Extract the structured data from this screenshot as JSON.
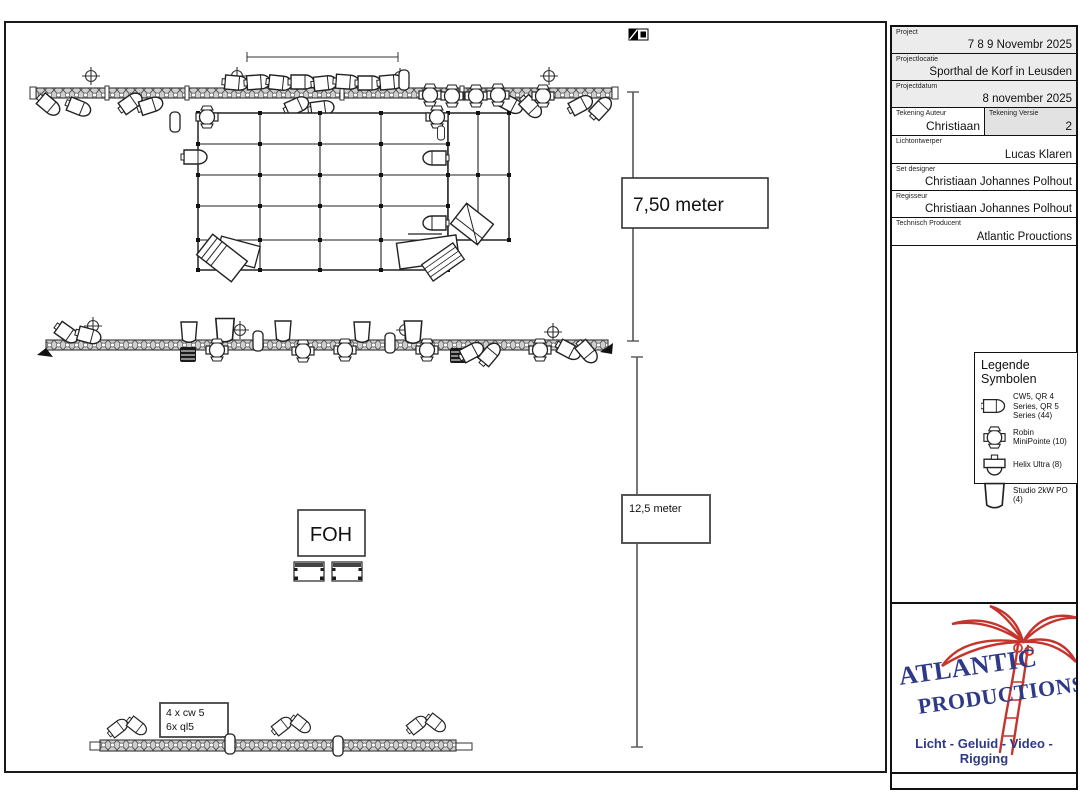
{
  "drawing": {
    "dim_width_label": "7,50 meter",
    "dim_depth_label": "12,5 meter",
    "foh_label": "FOH",
    "truss_note_line1": "4 x cw 5",
    "truss_note_line2": "6x ql5"
  },
  "title_block": {
    "rows": [
      {
        "label": "Project",
        "value": "7 8 9 Novembr 2025"
      },
      {
        "label": "Projectlocatie",
        "value": "Sporthal de Korf in Leusden"
      },
      {
        "label": "Projectdatum",
        "value": "8 november 2025"
      }
    ],
    "author_label": "Tekening Auteur",
    "author_value": "Christiaan",
    "version_label": "Tekening Versie",
    "version_value": "2",
    "rows2": [
      {
        "label": "Lichtontwerper",
        "value": "Lucas Klaren"
      },
      {
        "label": "Set designer",
        "value": "Christiaan Johannes Polhout"
      },
      {
        "label": "Regisseur",
        "value": "Christiaan Johannes Polhout"
      },
      {
        "label": "Technisch Producent",
        "value": "Atlantic Prouctions"
      }
    ]
  },
  "legend": {
    "title": "Legende Symbolen",
    "items": [
      {
        "icon": "wash-fixture-icon",
        "label": "CW5, QR 4 Series, QR 5 Series (44)"
      },
      {
        "icon": "moving-head-icon",
        "label": "Robin MiniPointe (10)"
      },
      {
        "icon": "helix-ultra-icon",
        "label": "Helix Ultra (8)"
      },
      {
        "icon": "par-can-icon",
        "label": "Studio 2kW PO (4)"
      }
    ]
  },
  "logo": {
    "line1": "ATLANTIC",
    "line2": "PRODUCTIONS",
    "tagline": "Licht - Geluid - Video - Rigging",
    "colors": {
      "blue": "#2e3a87",
      "red": "#c6352d"
    }
  }
}
